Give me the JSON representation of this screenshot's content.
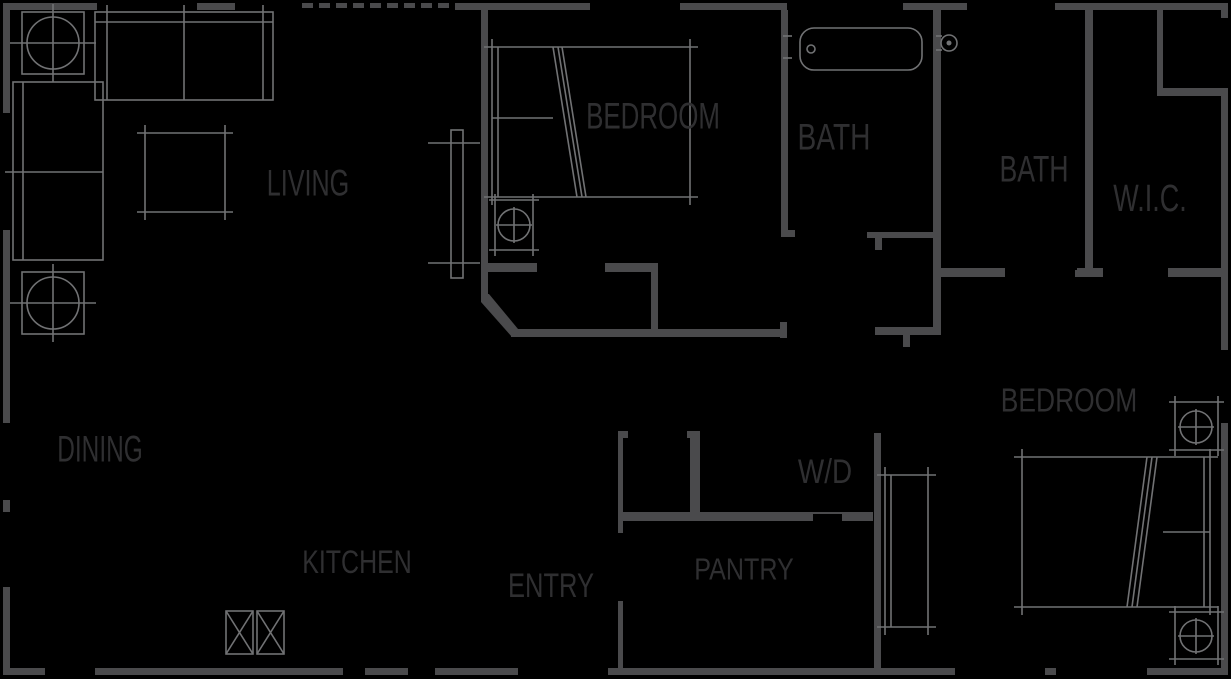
{
  "theme": {
    "background": "#000000",
    "wall": "#4a4a4c",
    "furniture": "#717274",
    "label": "#2f2f31"
  },
  "rooms": [
    {
      "id": "living",
      "label": "LIVING"
    },
    {
      "id": "bedroom1",
      "label": "BEDROOM"
    },
    {
      "id": "bath1",
      "label": "BATH"
    },
    {
      "id": "bath2",
      "label": "BATH"
    },
    {
      "id": "wic",
      "label": "W.I.C."
    },
    {
      "id": "dining",
      "label": "DINING"
    },
    {
      "id": "bedroom2",
      "label": "BEDROOM"
    },
    {
      "id": "wd",
      "label": "W/D"
    },
    {
      "id": "kitchen",
      "label": "KITCHEN"
    },
    {
      "id": "entry",
      "label": "ENTRY"
    },
    {
      "id": "pantry",
      "label": "PANTRY"
    }
  ]
}
